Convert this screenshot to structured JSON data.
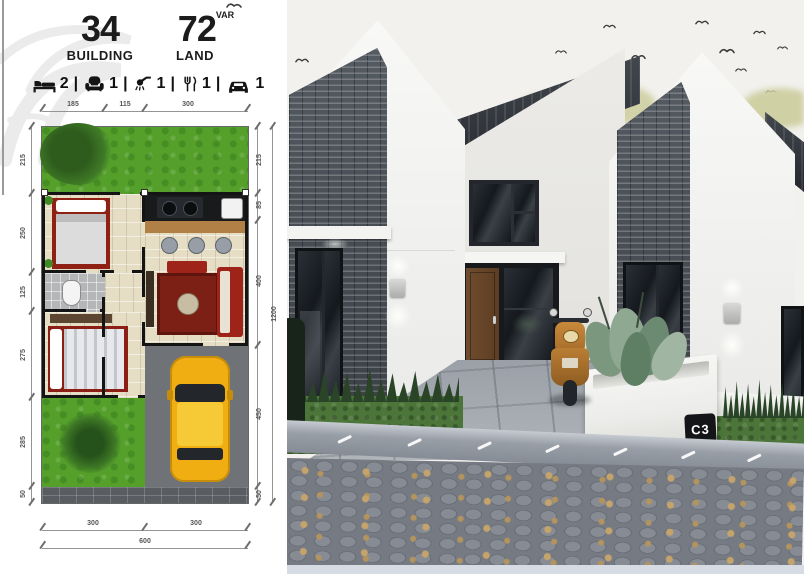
{
  "header": {
    "building": {
      "value": "34",
      "label": "BUILDING"
    },
    "land": {
      "value": "72",
      "sup": "VAR",
      "label": "LAND"
    }
  },
  "amenities": {
    "separator": "|",
    "items": [
      {
        "icon": "bed-icon",
        "count": "2"
      },
      {
        "icon": "sofa-icon",
        "count": "1"
      },
      {
        "icon": "shower-icon",
        "count": "1"
      },
      {
        "icon": "dining-icon",
        "count": "1"
      },
      {
        "icon": "car-icon",
        "count": "1"
      }
    ]
  },
  "floor_plan": {
    "dims_top": [
      "185",
      "115",
      "300"
    ],
    "dims_left": [
      "215",
      "250",
      "125",
      "275",
      "285",
      "50"
    ],
    "dims_right": [
      "215",
      "85",
      "400",
      "450",
      "50"
    ],
    "dim_right_total": "1200",
    "dims_bottom": [
      "300",
      "300"
    ],
    "dim_bottom_total": "600"
  },
  "render": {
    "unit_badge": "C3"
  },
  "colors": {
    "accent_yellow": "#f0ae12",
    "roof_dark": "#33373d",
    "stone_dark": "#44494f",
    "plan_grass": "#55a02b",
    "render_grass": "#4c7639",
    "driveway": "#a6acb2",
    "scooter_orange": "#b97e33",
    "badge_bg": "#141518"
  }
}
